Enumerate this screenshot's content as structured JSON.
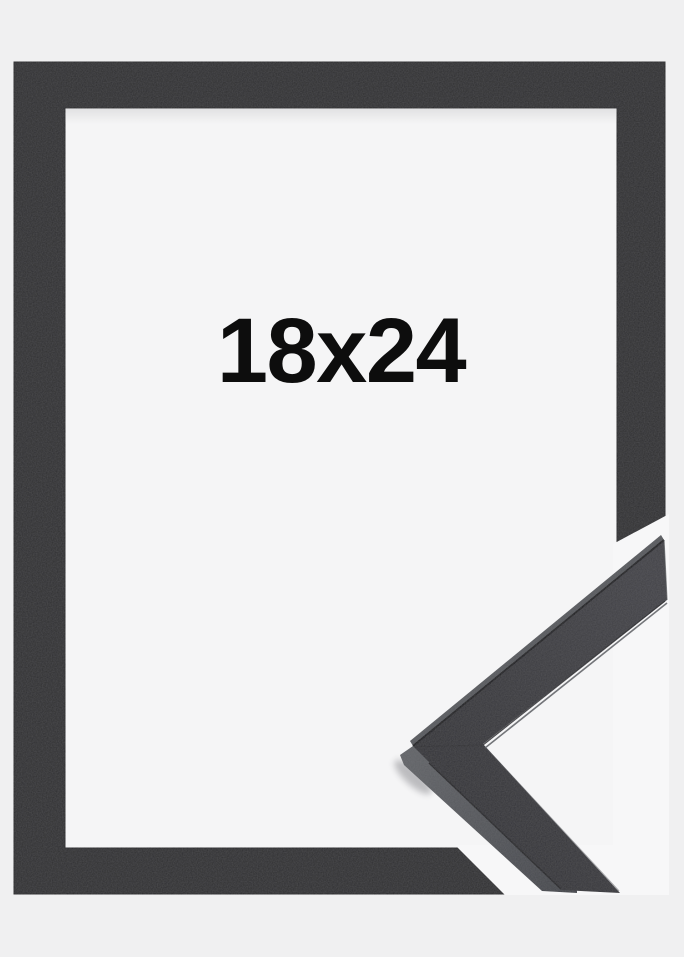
{
  "product_image": {
    "size_label": "18x24",
    "colors": {
      "background": "#f0f0f1",
      "glass": "#f5f5f6",
      "frame_black": "#2c2c2e",
      "frame_edge": "#1d1d1f",
      "overlay_white": "#f7f7f8",
      "detail_face": "#404045",
      "detail_face_shadow": "#303034",
      "detail_side": "#606266",
      "detail_side_dark": "#44464b",
      "detail_top_edge": "#56585c",
      "detail_ridge": "#141417",
      "label_text": "#0d0d0d"
    }
  }
}
